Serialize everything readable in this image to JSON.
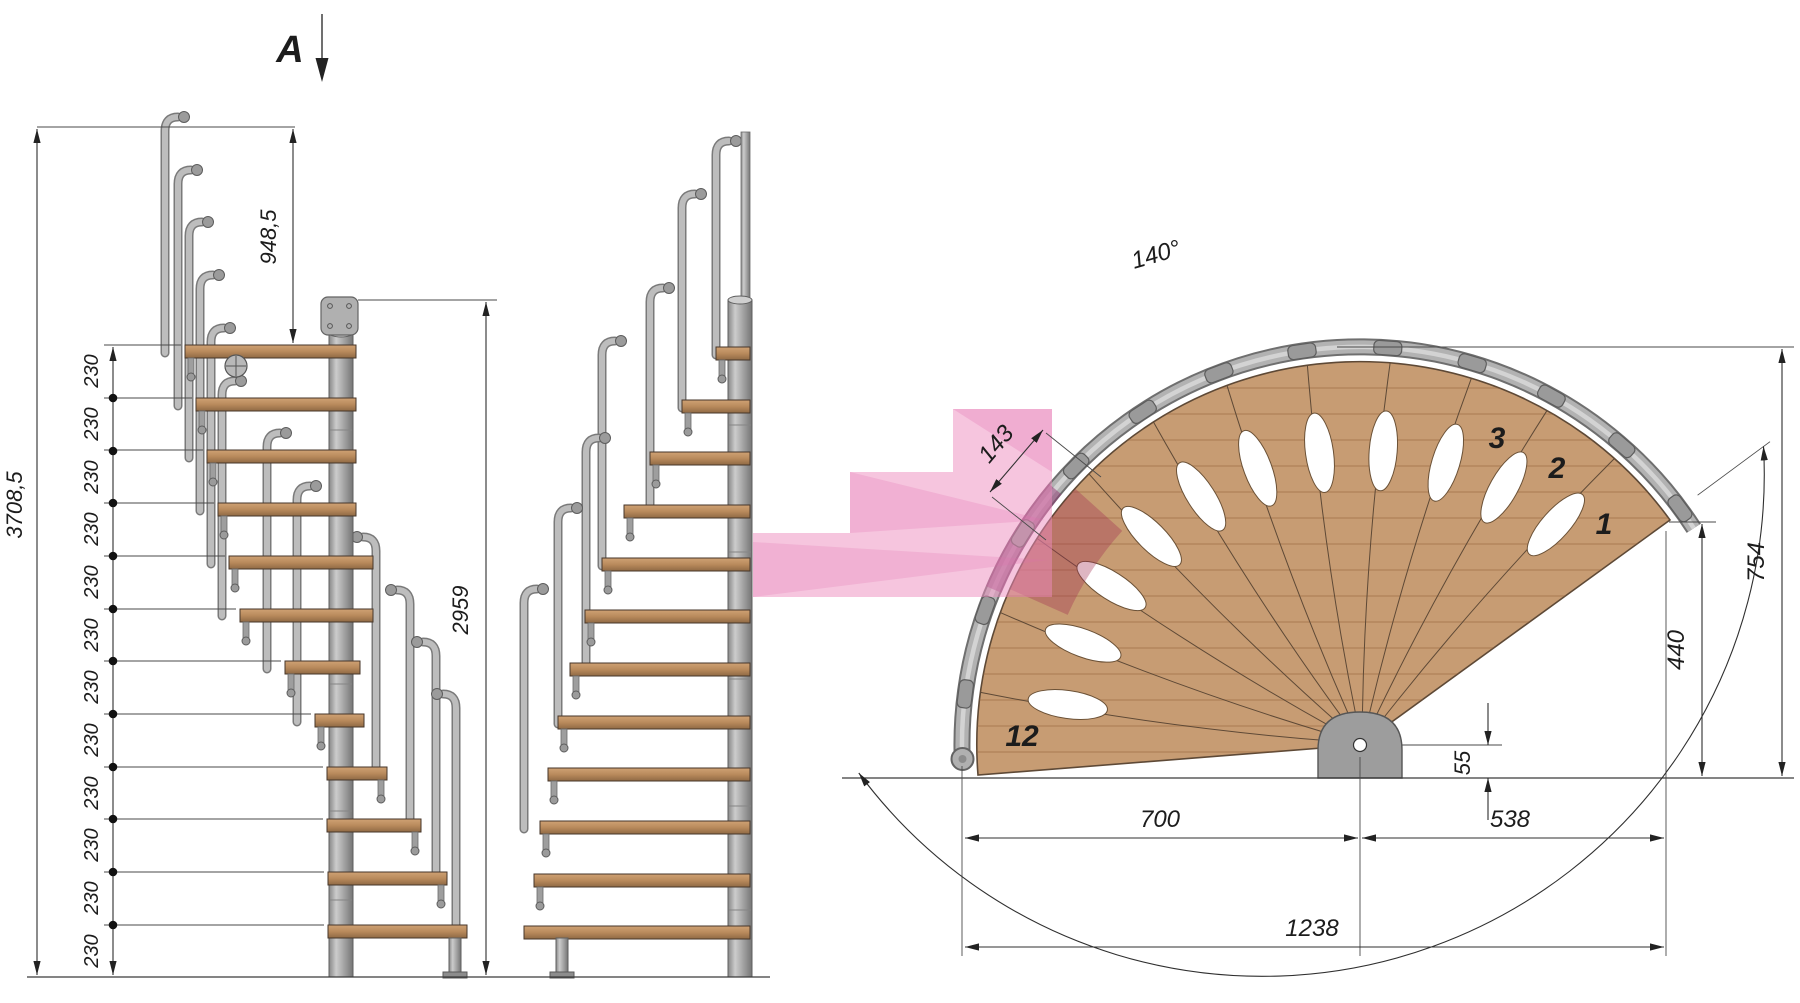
{
  "section_marker": {
    "label": "A"
  },
  "elevations": {
    "dim_total_height": "3708,5",
    "dim_top_rise": "948,5",
    "dim_pole_height": "2959",
    "dim_step_rise": "230",
    "step_count": 12
  },
  "plan": {
    "dim_rotation_angle": "140°",
    "dim_tread_going": "143",
    "dim_outer_radius": "754",
    "dim_corner_height": "440",
    "dim_center_offset": "55",
    "dim_span_left": "700",
    "dim_span_right": "538",
    "dim_span_total": "1238",
    "tread_first": "1",
    "tread_second": "2",
    "tread_third": "3",
    "tread_last": "12"
  },
  "colors": {
    "highlight_pink": "#f2a9cc",
    "tread_wood": "#c79c73",
    "metal_gray": "#a8a8a8",
    "dimension_line": "#2f2f2f"
  }
}
